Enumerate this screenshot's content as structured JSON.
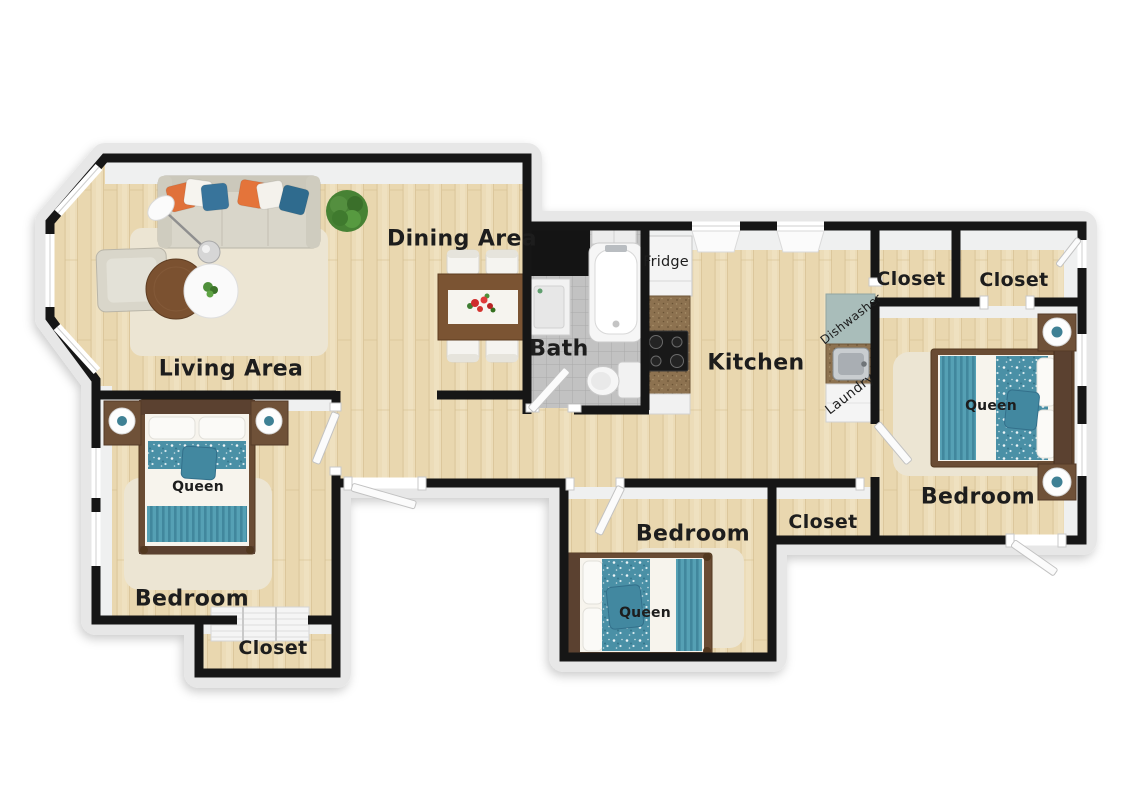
{
  "labels": {
    "living_area": "Living Area",
    "dining_area": "Dining Area",
    "bath": "Bath",
    "kitchen": "Kitchen",
    "fridge": "Fridge",
    "dishwasher": "Dishwasher",
    "laundry": "Laundry",
    "closet_top_left": "Closet",
    "closet_top_right": "Closet",
    "closet_middle": "Closet",
    "closet_bottom_left": "Closet",
    "bedroom_left": "Bedroom",
    "bedroom_middle": "Bedroom",
    "bedroom_right": "Bedroom",
    "bed_left_size": "Queen",
    "bed_middle_size": "Queen",
    "bed_right_size": "Queen"
  },
  "colors": {
    "wall": "#161616",
    "wood_floor": "#ecdcb8",
    "bath_tile": "#c2c2c2",
    "rug": "#ece5d3",
    "teal_bedding": "#4a90a6",
    "teal_pillow": "#38749b",
    "orange_pillow": "#e0713a",
    "sofa": "#d9d6ca",
    "wood_furniture": "#7b5433",
    "bed_frame": "#5b4130",
    "counter_speckle": "#8d7250",
    "dishwasher_top": "#a9bdba",
    "plant_green": "#478234",
    "flower_red": "#cf2b2b",
    "label_text": "#1d1d1d",
    "background": "#ffffff"
  }
}
